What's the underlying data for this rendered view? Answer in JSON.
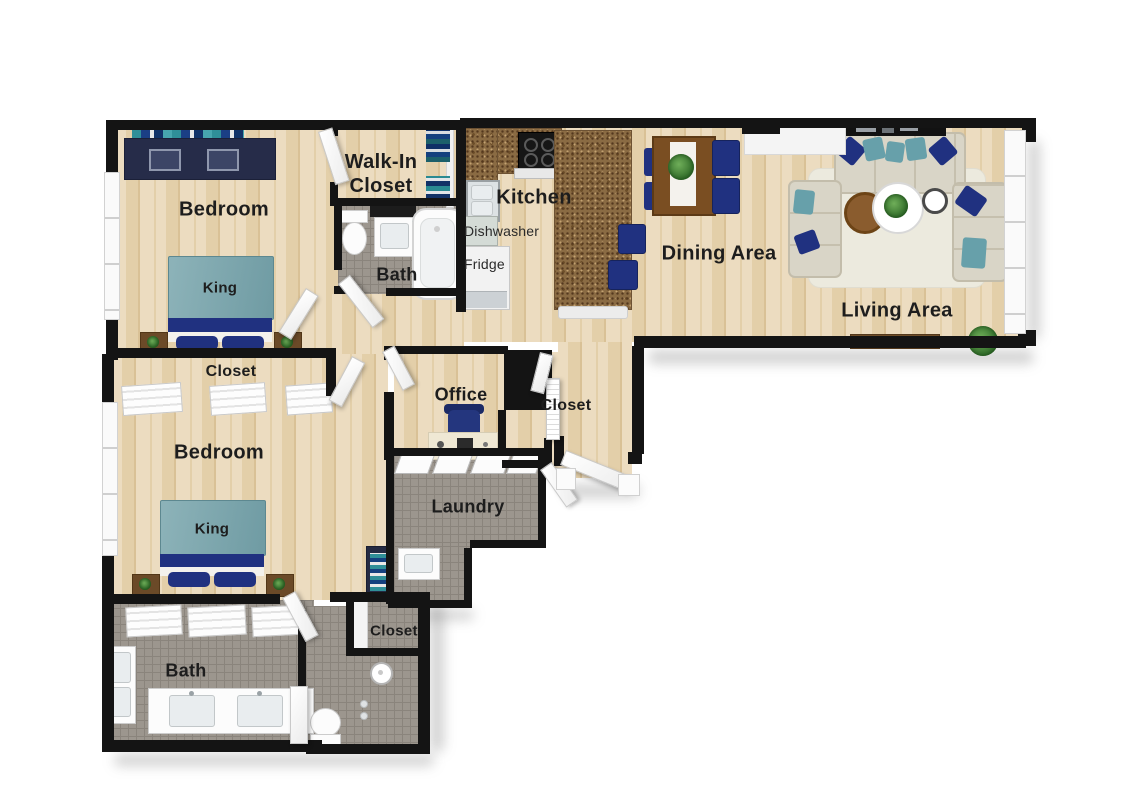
{
  "labels": {
    "bedroom_1": "Bedroom",
    "walk_in_closet": "Walk-In Closet",
    "bath_1": "Bath",
    "kitchen": "Kitchen",
    "dishwasher": "Dishwasher",
    "fridge": "Fridge",
    "dining": "Dining Area",
    "living": "Living Area",
    "closet_bedroom_2": "Closet",
    "bedroom_2": "Bedroom",
    "king_1": "King",
    "king_2": "King",
    "office": "Office",
    "closet_hall": "Closet",
    "laundry": "Laundry",
    "closet_bath_2": "Closet",
    "bath_2": "Bath"
  },
  "palette": {
    "wall": "#141414",
    "wood_light": "#ecdcc0",
    "wood_mid": "#e3cfa9",
    "wood_dark": "#d9c196",
    "tile": "#9c968e",
    "tile_line": "#8a847c",
    "granite": "#8a6b43",
    "navy": "#203180",
    "teal": "#67a0aa",
    "blanket_teal": "#7fa9b0",
    "sofa": "#d9d5c7",
    "rug": "#eceade",
    "table_brown": "#7a4e22",
    "plant_green": "#3d7a33",
    "text": "#1d1d1d"
  }
}
